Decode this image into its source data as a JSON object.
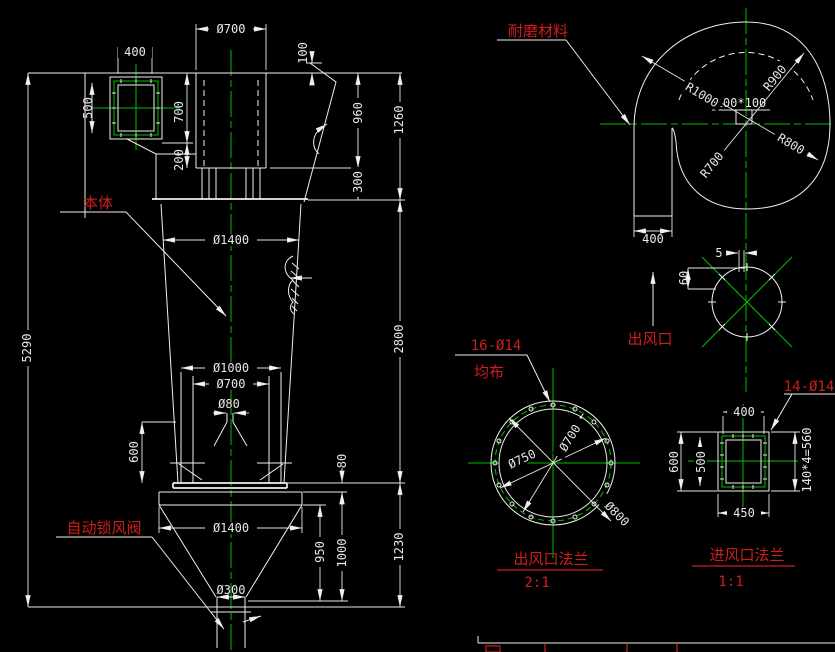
{
  "colors": {
    "background": "#000000",
    "line": "#f0f0f0",
    "centerline": "#00c000",
    "label_red": "#cf1d1d"
  },
  "main_view": {
    "body_label": "本体",
    "valve_label": "自动锁风阀",
    "dims": {
      "inlet_box_width": "400",
      "inlet_box_height": "500",
      "outlet_pipe_dia": "Ø700",
      "top_offset": "100",
      "inlet_drop": "700",
      "skirt_height": "200",
      "pipe_height": "960",
      "ring_height": "300",
      "head_height": "1260",
      "body_dia": "Ø1400",
      "cone_height": "2800",
      "total_height": "5290",
      "shell_dia": "Ø1000",
      "inner_pipe_dia": "Ø700",
      "vortex_dia": "Ø80",
      "stand_height": "600",
      "plate_gap": "80",
      "hopper_dia": "Ø1400",
      "hopper_depth": "950",
      "hopper_height": "1000",
      "base_height": "1230",
      "discharge_dia": "Ø300"
    }
  },
  "volute_view": {
    "material_label": "耐磨材料",
    "dims": {
      "r1": "R1000",
      "r2": "R900",
      "r3": "R800",
      "r4": "R700",
      "throat": "100*100",
      "duct_width": "400"
    }
  },
  "outlet_view": {
    "label": "出风口",
    "dims": {
      "lip": "5",
      "depth": "60"
    }
  },
  "outlet_flange": {
    "holes_note": "16-Ø14",
    "holes_note2": "均布",
    "dims": {
      "bolt_circle_dia": "Ø750",
      "bore_dia": "Ø700",
      "outer_dia": "Ø800"
    },
    "title": "出风口法兰",
    "scale": "2:1"
  },
  "inlet_flange": {
    "holes_note": "14-Ø14",
    "dims": {
      "bore_width": "400",
      "bore_height": "500",
      "outer_height": "600",
      "outer_width": "450",
      "bolt_spacing": "140*4=560"
    },
    "title": "进风口法兰",
    "scale": "1:1"
  }
}
